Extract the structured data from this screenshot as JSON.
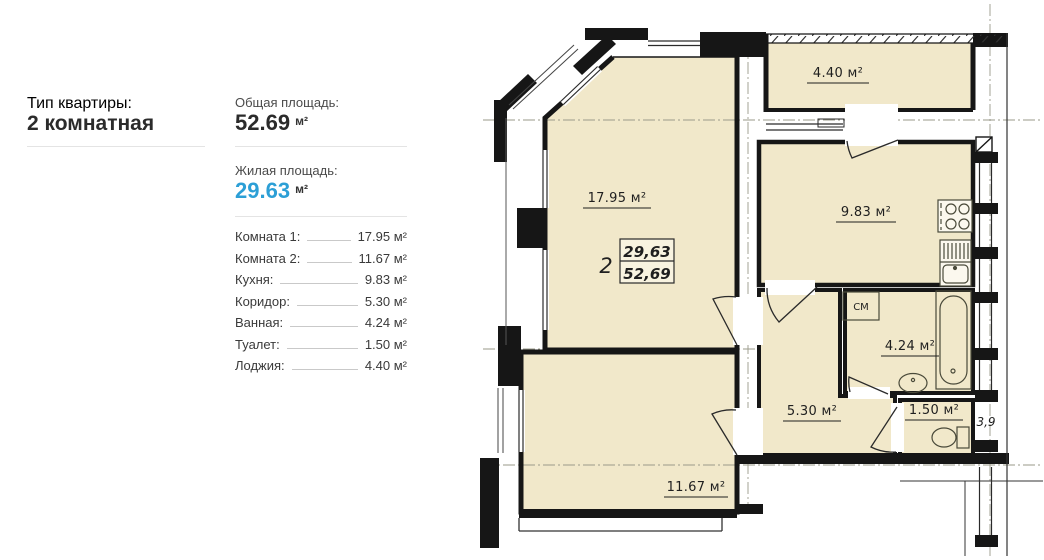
{
  "panel": {
    "type_label": "Тип квартиры:",
    "type_value": "2 комнатная",
    "total_label": "Общая площадь:",
    "total_value": "52.69",
    "total_unit": "м²",
    "living_label": "Жилая площадь:",
    "living_value": "29.63",
    "living_unit": "м²",
    "rooms": [
      {
        "label": "Комната 1:",
        "value": "17.95 м²"
      },
      {
        "label": "Комната 2:",
        "value": "11.67 м²"
      },
      {
        "label": "Кухня:",
        "value": "9.83 м²"
      },
      {
        "label": "Коридор:",
        "value": "5.30 м²"
      },
      {
        "label": "Ванная:",
        "value": "4.24 м²"
      },
      {
        "label": "Туалет:",
        "value": "1.50 м²"
      },
      {
        "label": "Лоджия:",
        "value": "4.40 м²"
      }
    ]
  },
  "plan": {
    "room_labels": {
      "room1": "17.95 м²",
      "room2": "11.67 м²",
      "kitchen": "9.83 м²",
      "corridor": "5.30 м²",
      "bathroom": "4.24 м²",
      "toilet": "1.50 м²",
      "loggia": "4.40 м²"
    },
    "stamp": {
      "number": "2",
      "living": "29,63",
      "total": "52,69"
    },
    "washer_label": "СМ",
    "dim_label": "3,9",
    "colors": {
      "room_fill": "#f1e8ca",
      "wall": "#161616",
      "accent_blue": "#2c9fd6",
      "divider_gray": "#e4e4e4"
    }
  }
}
